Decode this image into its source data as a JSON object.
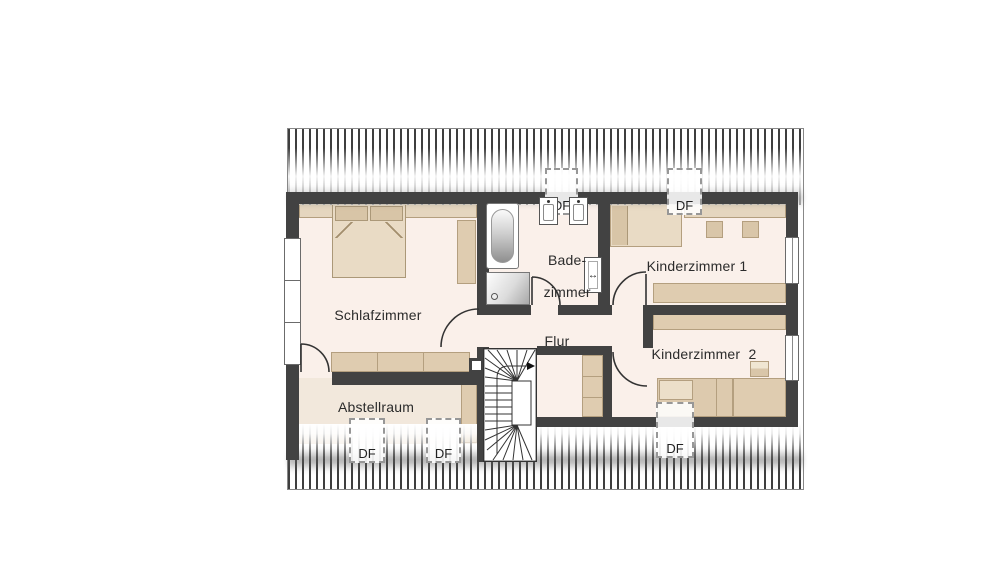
{
  "floorplan": {
    "type": "attic-floor-plan",
    "language": "de",
    "rooms": [
      {
        "id": "schlafzimmer",
        "label": "Schlafzimmer"
      },
      {
        "id": "badezimmer",
        "label": "Bade-zimmer",
        "line1": "Bade-",
        "line2": "zimmer"
      },
      {
        "id": "flur",
        "label": "Flur"
      },
      {
        "id": "kinderzimmer1",
        "label": "Kinderzimmer 1"
      },
      {
        "id": "kinderzimmer2",
        "label": "Kinderzimmer  2"
      },
      {
        "id": "abstellraum",
        "label": "Abstellraum"
      }
    ],
    "roof_windows": [
      {
        "id": "df-bad",
        "label": "DF",
        "location": "top wall above Badezimmer"
      },
      {
        "id": "df-k1",
        "label": "DF",
        "location": "top wall above Kinderzimmer 1"
      },
      {
        "id": "df-abstell-1",
        "label": "DF",
        "location": "bottom roof slope, Abstellraum left"
      },
      {
        "id": "df-abstell-2",
        "label": "DF",
        "location": "bottom roof slope, Abstellraum right"
      },
      {
        "id": "df-k2",
        "label": "DF",
        "location": "bottom roof slope below Kinderzimmer 2"
      }
    ],
    "symbols": [
      "double-bed",
      "sofa",
      "wardrobe",
      "bathtub",
      "shower",
      "washbasin",
      "washbasin",
      "wall-fixture",
      "winder-staircase",
      "hall-cabinet",
      "single-bed",
      "desk",
      "chair",
      "chair",
      "shelf",
      "side-table",
      "dresser",
      "chimney",
      "window",
      "roof-hatching"
    ],
    "palette": {
      "wall": "#424242",
      "floor": "#faf0ea",
      "floor_abstellraum": "#f2e8dc",
      "furniture": "#dfccb0",
      "furniture_border": "#b49f7f",
      "bed": "#e9dbc5",
      "pillow": "#d8c5a7",
      "hatch_line": "#3e3e3e",
      "roof_outline": "#888888",
      "label_text": "#2b2b2b"
    }
  }
}
